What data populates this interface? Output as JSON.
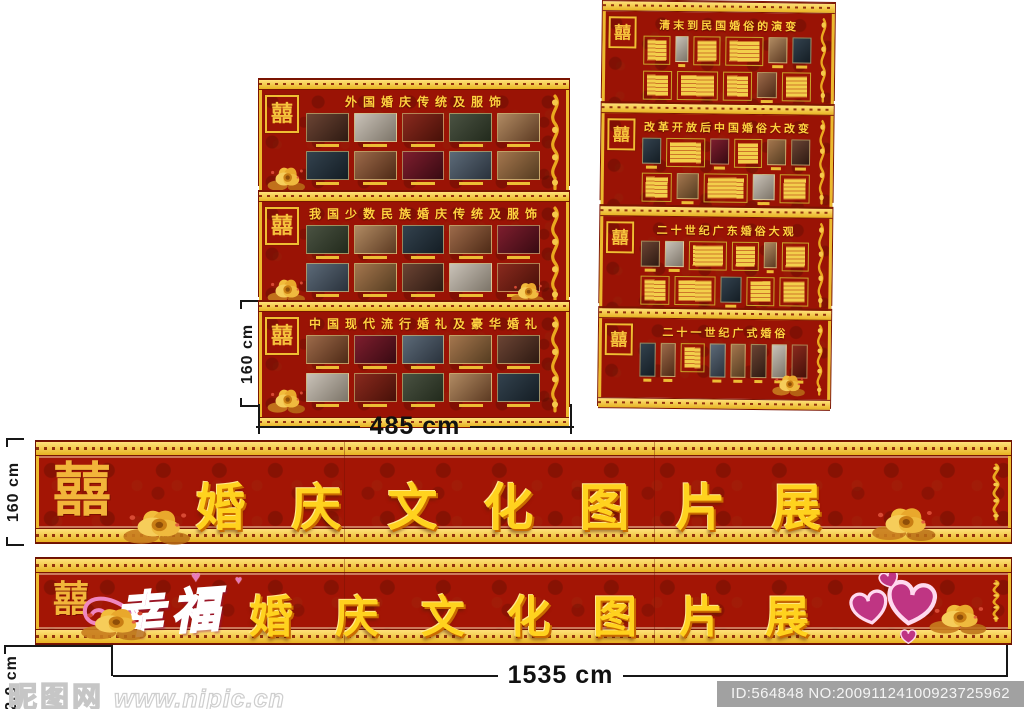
{
  "decor": {
    "double_happiness": "囍",
    "colors": {
      "board_red": "#9a1305",
      "border_gold": "#edbb2e",
      "title_yellow": "#ffd23f",
      "banner_text_yellow": "#ffd21e",
      "heart_pink": "#bf3583",
      "happiness_script_pink": "#d5509e"
    }
  },
  "left_boards": {
    "height_label": "160 cm",
    "width_label": "485 cm",
    "panels": [
      {
        "title": "外国婚庆传统及服饰"
      },
      {
        "title": "我国少数民族婚庆传统及服饰"
      },
      {
        "title": "中国现代流行婚礼及豪华婚礼"
      }
    ]
  },
  "right_boards": {
    "panels": [
      {
        "title": "清末到民国婚俗的演变"
      },
      {
        "title": "改革开放后中国婚俗大改变"
      },
      {
        "title": "二十世纪广东婚俗大观"
      },
      {
        "title": "二十一世纪广式婚俗"
      }
    ]
  },
  "main_banner": {
    "height_label": "160 cm",
    "text": "婚庆文化图片展"
  },
  "bottom_banner": {
    "height_label": "2.0 cm",
    "width_label": "1535 cm",
    "script_prefix": "幸福",
    "text": "婚庆文化图片展"
  },
  "watermark": {
    "site_logo": "昵图网",
    "site_url": "www.nipic.cn",
    "image_id": "ID:564848 NO:20091124100923725962"
  }
}
